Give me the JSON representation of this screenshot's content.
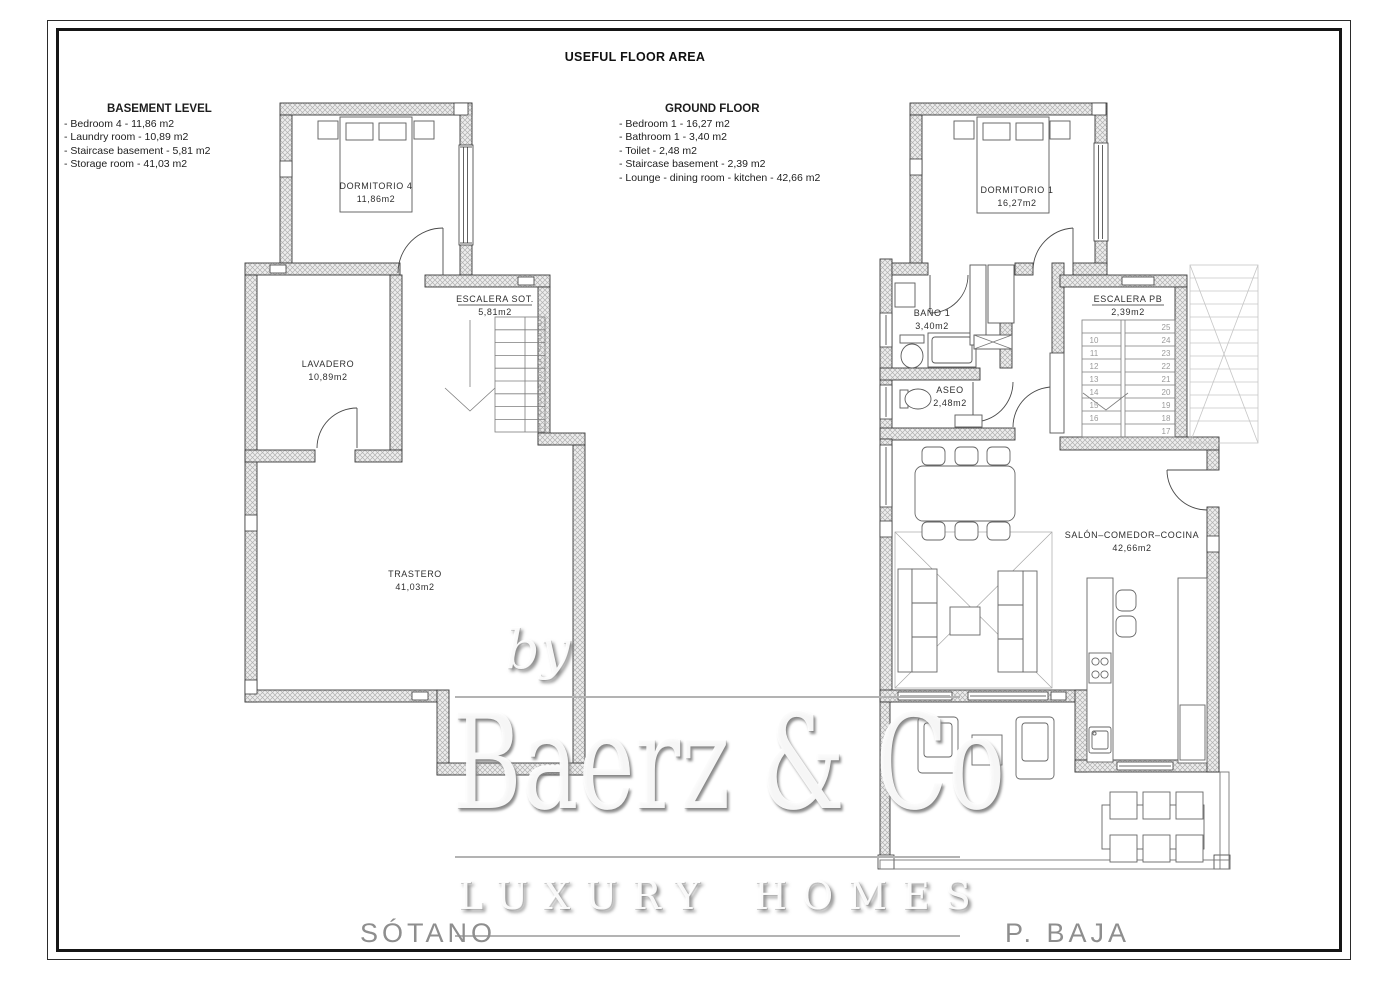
{
  "page": {
    "title": "USEFUL FLOOR AREA"
  },
  "legend_basement": {
    "title": "BASEMENT LEVEL",
    "items": [
      "- Bedroom 4 - 11,86 m2",
      "- Laundry room - 10,89 m2",
      "- Staircase basement - 5,81 m2",
      "- Storage room - 41,03 m2"
    ]
  },
  "legend_ground": {
    "title": "GROUND FLOOR",
    "items": [
      "- Bedroom 1 - 16,27 m2",
      "- Bathroom 1 - 3,40 m2",
      "- Toilet - 2,48 m2",
      "- Staircase basement - 2,39 m2",
      "- Lounge - dining room - kitchen - 42,66 m2"
    ]
  },
  "plans": {
    "basement": {
      "floor_label": "SÓTANO",
      "rooms": {
        "dormitorio4": {
          "name": "DORMITORIO  4",
          "area": "11,86m2"
        },
        "lavadero": {
          "name": "LAVADERO",
          "area": "10,89m2"
        },
        "escalera": {
          "name": "ESCALERA  SOT.",
          "area": "5,81m2"
        },
        "trastero": {
          "name": "TRASTERO",
          "area": "41,03m2"
        }
      },
      "stair_numbers": [
        "9",
        "8",
        "7",
        "6",
        "5",
        "4",
        "3",
        "2",
        "1"
      ]
    },
    "ground": {
      "floor_label": "P.  BAJA",
      "rooms": {
        "dormitorio1": {
          "name": "DORMITORIO  1",
          "area": "16,27m2"
        },
        "bano": {
          "name": "BAÑO  1",
          "area": "3,40m2"
        },
        "aseo": {
          "name": "ASEO",
          "area": "2,48m2"
        },
        "escalera": {
          "name": "ESCALERA  PB",
          "area": "2,39m2"
        },
        "salon": {
          "name": "SALÓN–COMEDOR–COCINA",
          "area": "42,66m2"
        }
      },
      "stair_numbers_left": [
        "10",
        "11",
        "12",
        "13",
        "14",
        "15",
        "16"
      ],
      "stair_numbers_right": [
        "25",
        "24",
        "23",
        "22",
        "21",
        "20",
        "19",
        "18",
        "17"
      ]
    }
  },
  "watermark": {
    "by": "by",
    "brand": "Baerz & Co",
    "tagline": "LUXURY HOMES"
  },
  "colors": {
    "wall_outline": "#3a3a3a",
    "wall_hatch": "#b0b0b0",
    "watermark_gray": "#b3b3b3",
    "floor_label_gray": "#8e8e8e"
  }
}
